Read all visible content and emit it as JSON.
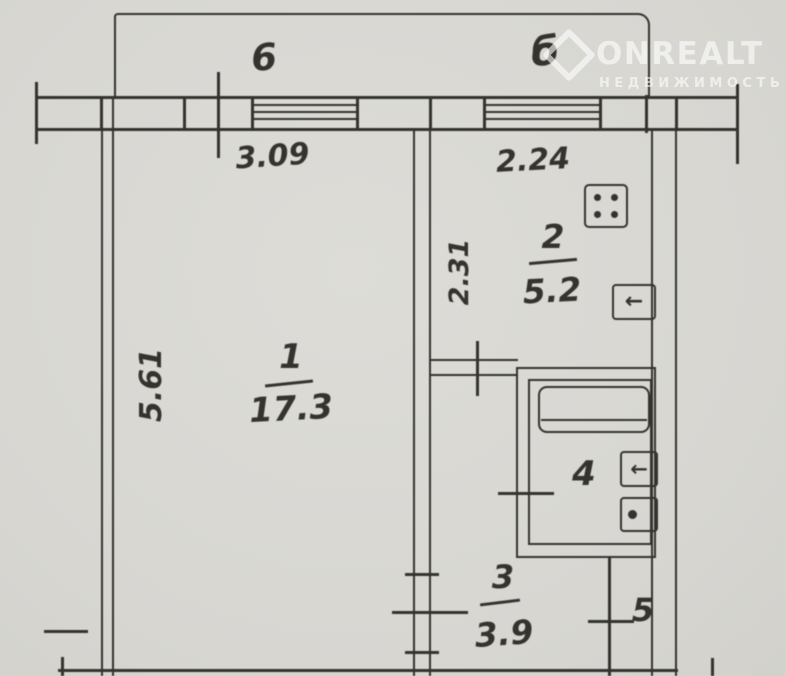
{
  "watermark": {
    "brand": "ONREALT",
    "subtitle": "НЕДВИЖИМОСТЬ"
  },
  "rooms": {
    "room1": {
      "number": "1",
      "area": "17.3"
    },
    "room2": {
      "number": "2",
      "area": "5.2"
    },
    "room3": {
      "number": "3",
      "area": "3.9"
    },
    "room4": {
      "number": "4"
    },
    "room5": {
      "number": "5"
    },
    "balcony_left": {
      "label": "6"
    },
    "balcony_right": {
      "label": "б"
    }
  },
  "dimensions": {
    "top_left_width": "3.09",
    "top_right_width": "2.24",
    "left_height": "5.61",
    "kitchen_height": "2.31"
  },
  "icons": {
    "arrow_glyph": "←"
  },
  "colors": {
    "paper": "#d9d8d3",
    "ink": "#35332e",
    "watermark": "rgba(255,255,255,0.6)"
  }
}
